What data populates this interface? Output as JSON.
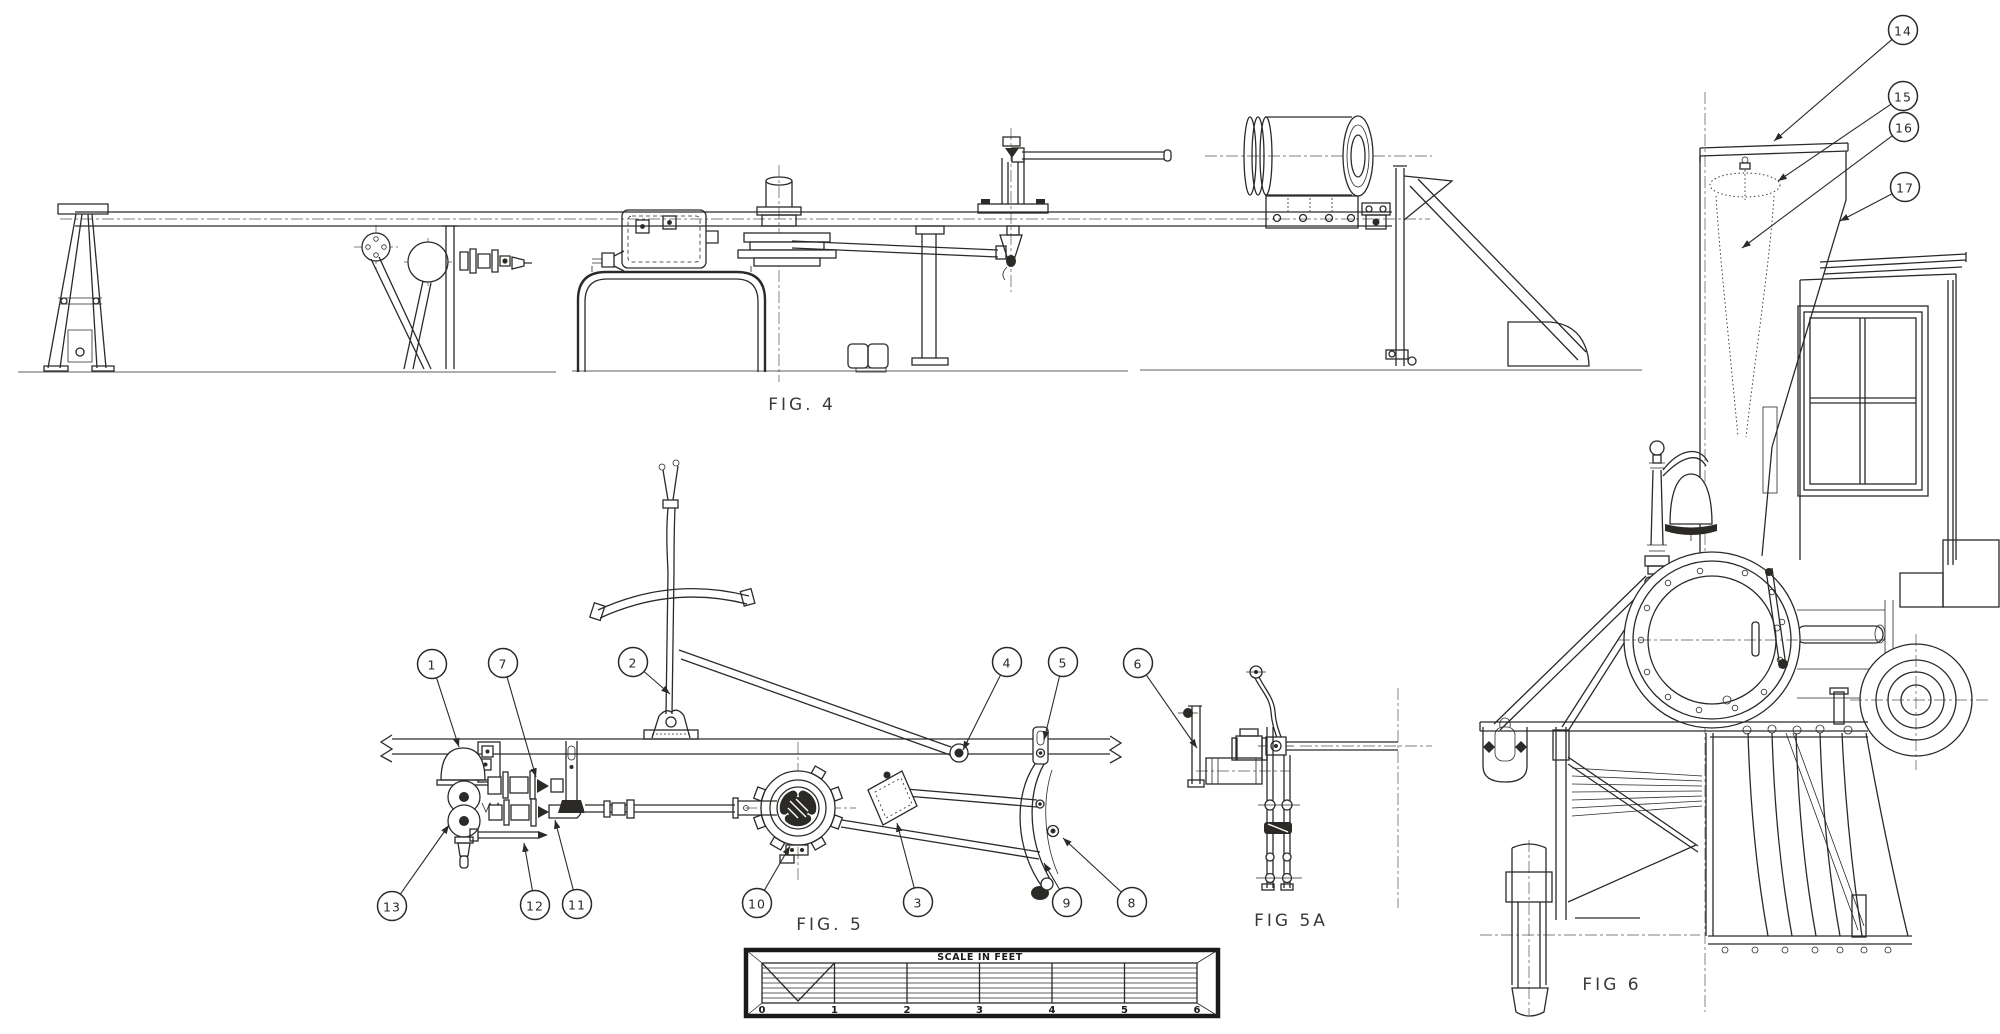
{
  "colors": {
    "ink": "#2c2a27",
    "paper": "#ffffff"
  },
  "figures": {
    "fig4": {
      "label": "FIG. 4"
    },
    "fig5": {
      "label": "FIG. 5"
    },
    "fig5a": {
      "label": "FIG 5A"
    },
    "fig6": {
      "label": "FIG 6"
    }
  },
  "scale_bar": {
    "title": "SCALE IN FEET",
    "ticks": [
      "0",
      "1",
      "2",
      "3",
      "4",
      "5",
      "6"
    ]
  },
  "callouts": {
    "fig5": [
      {
        "n": "1",
        "x": 432,
        "y": 664,
        "tx": 459,
        "ty": 747
      },
      {
        "n": "7",
        "x": 503,
        "y": 663,
        "tx": 536,
        "ty": 777
      },
      {
        "n": "2",
        "x": 633,
        "y": 662,
        "tx": 670,
        "ty": 694
      },
      {
        "n": "4",
        "x": 1007,
        "y": 662,
        "tx": 963,
        "ty": 750
      },
      {
        "n": "5",
        "x": 1063,
        "y": 662,
        "tx": 1044,
        "ty": 740
      },
      {
        "n": "6",
        "x": 1138,
        "y": 663,
        "tx": 1197,
        "ty": 748
      },
      {
        "n": "13",
        "x": 392,
        "y": 906,
        "tx": 449,
        "ty": 825
      },
      {
        "n": "12",
        "x": 535,
        "y": 905,
        "tx": 524,
        "ty": 843
      },
      {
        "n": "11",
        "x": 577,
        "y": 904,
        "tx": 555,
        "ty": 820
      },
      {
        "n": "10",
        "x": 757,
        "y": 903,
        "tx": 790,
        "ty": 846
      },
      {
        "n": "3",
        "x": 918,
        "y": 902,
        "tx": 897,
        "ty": 823
      },
      {
        "n": "9",
        "x": 1067,
        "y": 902,
        "tx": 1044,
        "ty": 863
      },
      {
        "n": "8",
        "x": 1132,
        "y": 902,
        "tx": 1063,
        "ty": 838
      }
    ],
    "fig6": [
      {
        "n": "14",
        "x": 1903,
        "y": 30,
        "tx": 1774,
        "ty": 141
      },
      {
        "n": "15",
        "x": 1903,
        "y": 96,
        "tx": 1778,
        "ty": 181
      },
      {
        "n": "16",
        "x": 1904,
        "y": 127,
        "tx": 1742,
        "ty": 248
      },
      {
        "n": "17",
        "x": 1905,
        "y": 187,
        "tx": 1840,
        "ty": 221
      }
    ]
  }
}
